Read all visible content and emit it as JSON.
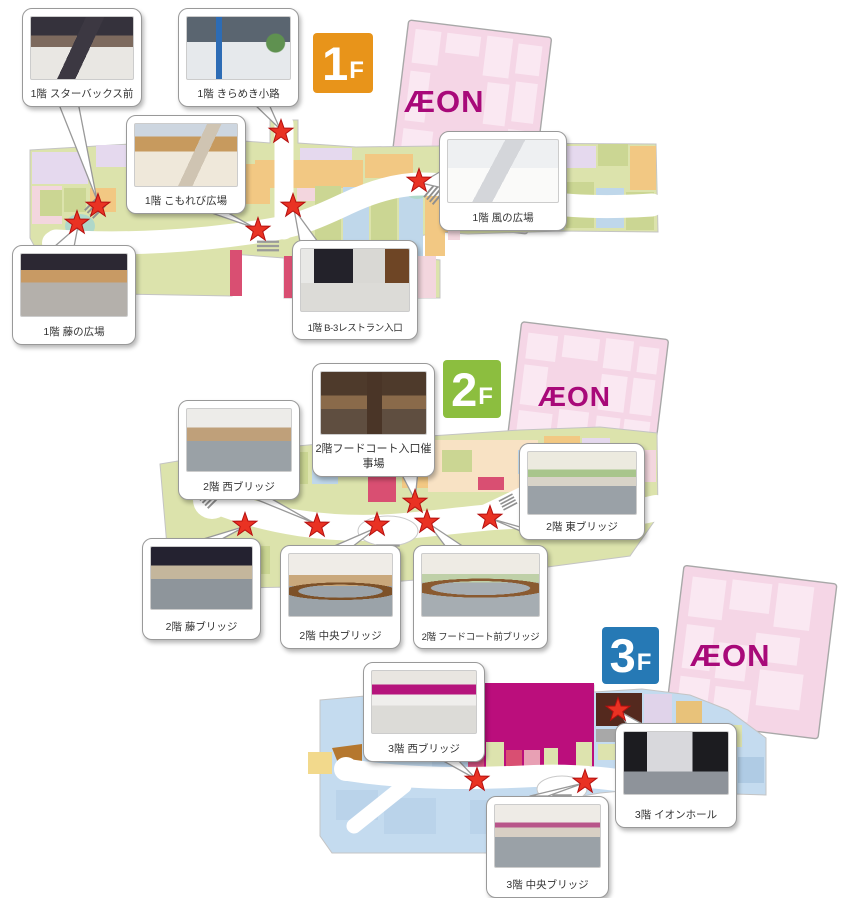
{
  "aeon_logo": "ÆON",
  "floors": [
    {
      "name": "1F",
      "badge": {
        "number": "1",
        "letter": "F",
        "color": "#E8941A"
      },
      "callouts": [
        {
          "label": "1階 スターバックス前"
        },
        {
          "label": "1階 きらめき小路"
        },
        {
          "label": "1階 こもれび広場"
        },
        {
          "label": "1階 風の広場"
        },
        {
          "label": "1階 藤の広場"
        },
        {
          "label": "1階 B-3レストラン入口"
        }
      ]
    },
    {
      "name": "2F",
      "badge": {
        "number": "2",
        "letter": "F",
        "color": "#8CBE3F"
      },
      "callouts": [
        {
          "label": "2階 西ブリッジ"
        },
        {
          "label": "2階フードコート入口催事場"
        },
        {
          "label": "2階 東ブリッジ"
        },
        {
          "label": "2階 藤ブリッジ"
        },
        {
          "label": "2階 中央ブリッジ"
        },
        {
          "label": "2階 フードコート前ブリッジ"
        }
      ]
    },
    {
      "name": "3F",
      "badge": {
        "number": "3",
        "letter": "F",
        "color": "#2679B5"
      },
      "callouts": [
        {
          "label": "3階 西ブリッジ"
        },
        {
          "label": "3階 イオンホール"
        },
        {
          "label": "3階 中央ブリッジ"
        }
      ]
    }
  ],
  "colors": {
    "map_base_green": "#DCE3AC",
    "map_base_blue": "#C4DBEF",
    "aeon_building_pink": "#F5D6E6",
    "aeon_logo_magenta": "#A80979",
    "star_red": "#E93223",
    "cinema_magenta": "#BB0E7C"
  }
}
